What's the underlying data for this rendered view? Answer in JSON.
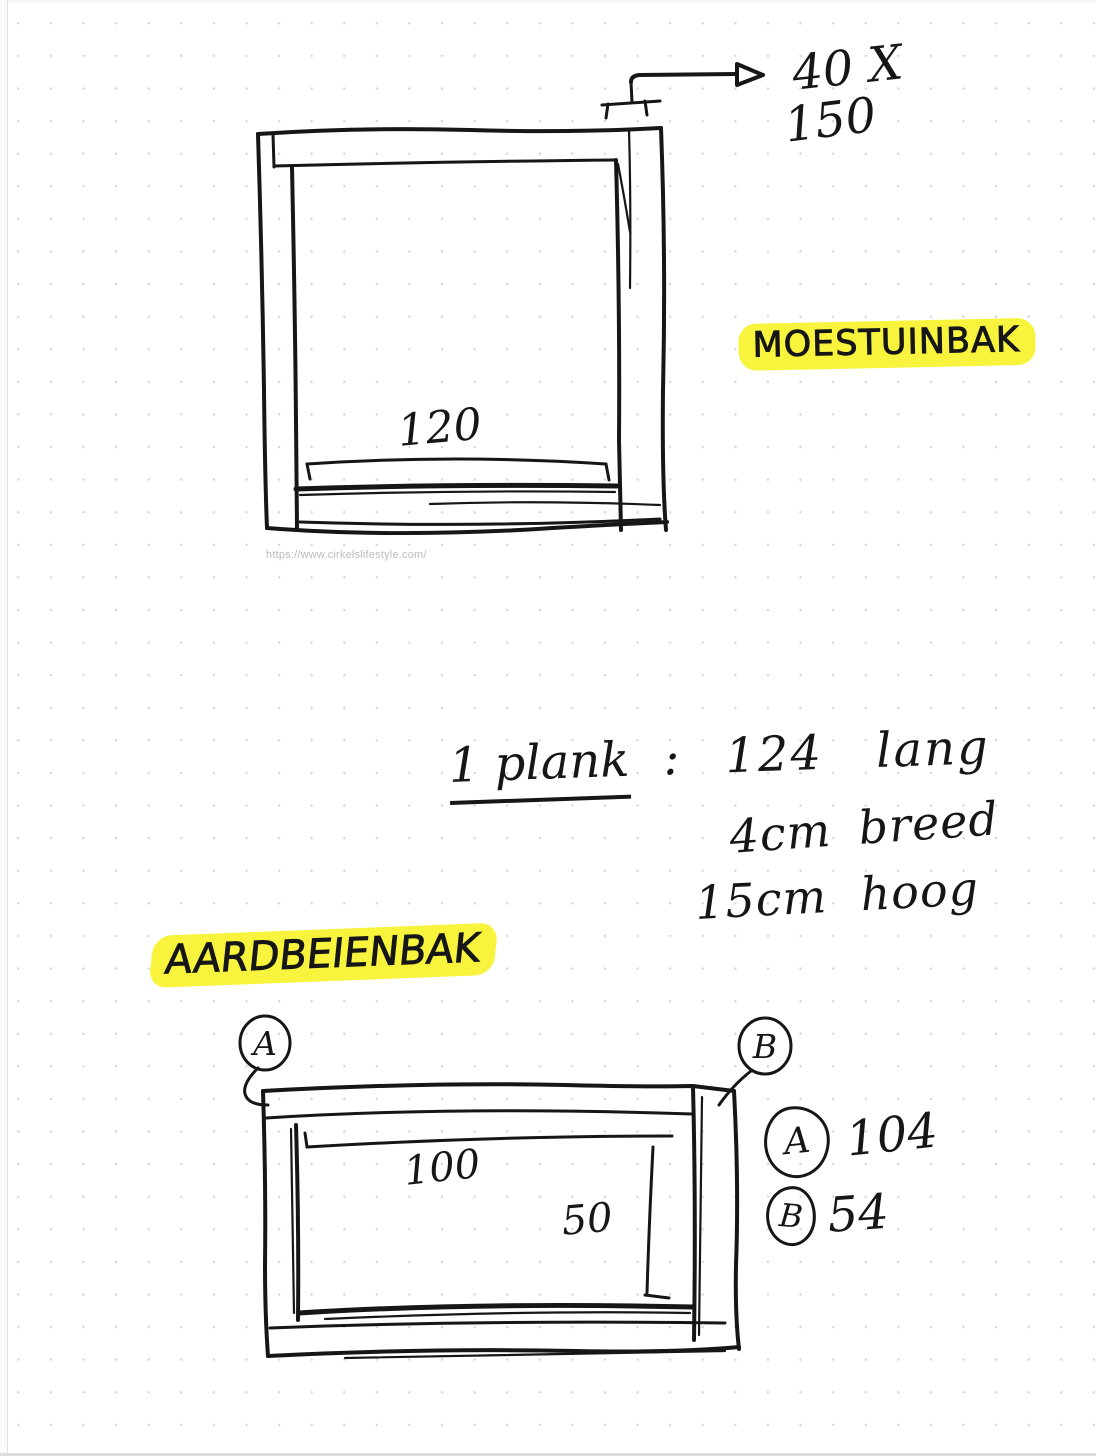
{
  "page": {
    "type": "dotted-grid-note",
    "ink_color": "#161616",
    "highlight_color": "#f8f43e",
    "dot_color": "#d7d7d7",
    "url_text_color": "#bcbcbc"
  },
  "moestuinbak": {
    "title": "MOESTUINBAK",
    "width_label": "120",
    "plank_cut": {
      "line1": "40 X",
      "line2": "150"
    },
    "source_url": "https://www.cirkelslifestyle.com/"
  },
  "plank_note": {
    "lead": "1 plank",
    "colon": ":",
    "length": "124 lang",
    "width": "4cm breed",
    "height": "15cm hoog"
  },
  "aardbeienbak": {
    "title": "AARDBEIENBAK",
    "length_label": "100",
    "width_label": "50",
    "callout_a": "A",
    "callout_b": "B",
    "legend": [
      {
        "key": "A",
        "value": "104"
      },
      {
        "key": "B",
        "value": "54"
      }
    ]
  }
}
